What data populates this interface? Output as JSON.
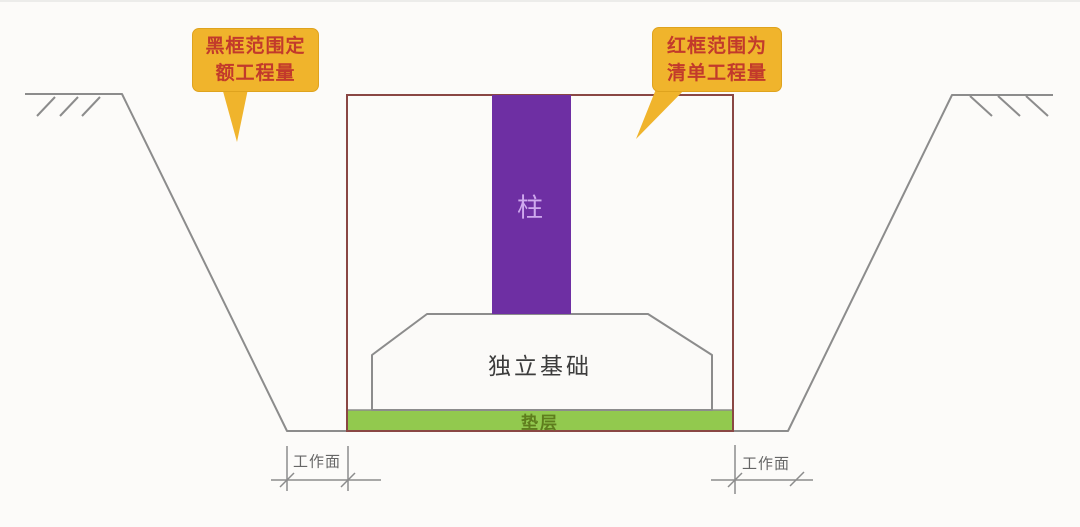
{
  "callouts": {
    "left": {
      "line1": "黑框范围定",
      "line2": "额工程量"
    },
    "right": {
      "line1": "红框范围为",
      "line2": "清单工程量"
    }
  },
  "labels": {
    "column": "柱",
    "foundation": "独立基础",
    "cushion": "垫层",
    "working_face_left": "工作面",
    "working_face_right": "工作面"
  },
  "colors": {
    "column_fill": "#6e2fa3",
    "column_label": "#cfa9ee",
    "cushion_fill": "#92c94e",
    "cushion_label": "#5e7d1d",
    "callout_bg": "#f0b42c",
    "callout_text": "#c23a2b",
    "frame_red": "#8a4744",
    "line_gray": "#8c8c8c",
    "foundation_fill": "#fbfaf8",
    "text_dark": "#3c3c3c",
    "dim_text": "#666666"
  }
}
